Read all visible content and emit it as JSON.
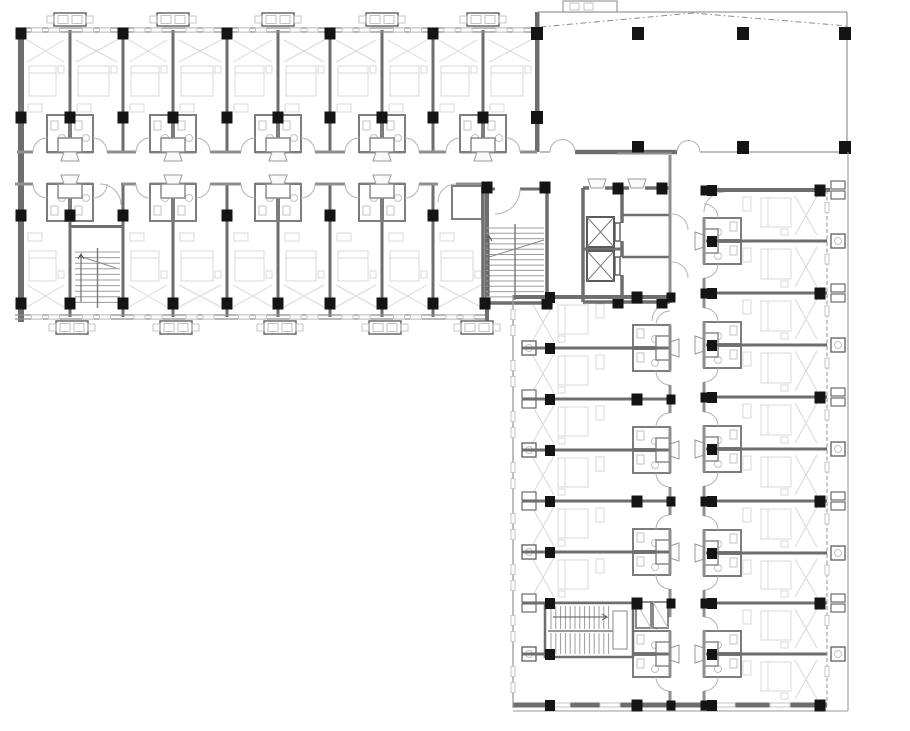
{
  "document": {
    "type": "architectural-floor-plan",
    "canvas": {
      "width": 910,
      "height": 731,
      "background": "#ffffff"
    },
    "summary": {
      "guest_rooms_top_wing": 18,
      "guest_rooms_bottom_wing": 17,
      "elevators": 2,
      "stairways": 3,
      "hall_columns": 6,
      "corridors": 2
    }
  },
  "colors": {
    "wall": "#6e6e6e",
    "wall_light": "#8f8f8f",
    "thin": "#9a9a9a",
    "column": "#141414",
    "fixture": "#c2c2c2",
    "furniture": "#d8d8d8",
    "door": "#b3b3b3",
    "tick": "#c6c6c6",
    "dash": "#8d8d8d",
    "white": "#ffffff"
  },
  "top_wing": {
    "party_walls": [
      21,
      70,
      123,
      173,
      227,
      278,
      330,
      382,
      433,
      483
    ],
    "left_wall_x": 21,
    "window_top_y": 30,
    "window_bottom_y": 317,
    "corridor_y": [
      152,
      184
    ],
    "top_row_span": [
      32,
      152
    ],
    "bottom_row_span": [
      184,
      315
    ],
    "end_wall_top": 537,
    "end_wall_bottom": 487,
    "pairs_top": [
      70,
      173,
      278,
      382,
      483
    ],
    "pairs_bottom": [
      70,
      173,
      278,
      382
    ],
    "single_door_bottom": [
      438,
      456
    ],
    "condensers_top": [
      70,
      173,
      278,
      382,
      483
    ],
    "condensers_bottom": [
      72,
      176,
      280,
      385,
      477
    ],
    "columns_y33": [
      21,
      123,
      227,
      330,
      433
    ],
    "columns_y117": [
      21,
      70,
      123,
      173,
      227,
      278,
      330,
      382,
      433,
      483
    ],
    "columns_y215": [
      21,
      70,
      123,
      227,
      330,
      433
    ],
    "columns_y303": [
      21,
      70,
      123,
      173,
      227,
      278,
      330,
      382,
      433
    ],
    "stair_bay": {
      "walls": [
        70,
        123
      ],
      "top_y": 225,
      "treads": [
        75,
        252,
        120,
        308
      ]
    }
  },
  "hall": {
    "left_wall_x": 537,
    "top_y": 12,
    "right_x": 847,
    "bottom_y": 152,
    "heavy_segment": [
      575,
      677
    ],
    "door_openings": [
      [
        550,
        575
      ],
      [
        677,
        700
      ]
    ],
    "canopy": [
      563,
      1,
      54,
      11
    ],
    "ridge_dash": [
      [
        540,
        27
      ],
      [
        693,
        13
      ],
      [
        847,
        26
      ]
    ],
    "columns": [
      [
        638,
        33
      ],
      [
        743,
        33
      ],
      [
        845,
        33
      ],
      [
        638,
        147
      ],
      [
        743,
        147
      ],
      [
        845,
        147
      ],
      [
        537,
        33
      ],
      [
        537,
        117
      ]
    ]
  },
  "core": {
    "vestibule_wall_y": 189,
    "vestibule_gap": [
      495,
      520
    ],
    "stair": {
      "x1": 483,
      "x2": 547,
      "y1": 189,
      "y2": 305,
      "treads_y": [
        228,
        300
      ],
      "rail_x": 515
    },
    "elevator_shaft": {
      "x1": 583,
      "x2": 622,
      "y1": 188,
      "y2": 302
    },
    "elevator_cars": [
      [
        587,
        217,
        27,
        30
      ],
      [
        587,
        251,
        27,
        30
      ]
    ],
    "service_rooms": {
      "x1": 622,
      "x2": 670,
      "dividers_y": [
        215,
        257
      ]
    },
    "door_marks_up": [
      597,
      637
    ],
    "columns": [
      [
        487,
        187
      ],
      [
        545,
        187
      ],
      [
        485,
        303
      ],
      [
        547,
        303
      ],
      [
        618,
        188
      ],
      [
        662,
        188
      ],
      [
        618,
        302
      ],
      [
        662,
        302
      ]
    ]
  },
  "bottom_wing": {
    "corridor_x": [
      670,
      704
    ],
    "left_column": {
      "room_x": [
        522,
        670
      ],
      "walls": [
        297,
        348,
        399,
        450,
        501,
        552,
        603,
        654,
        705
      ],
      "heavy": [
        297,
        399,
        501,
        603,
        705
      ],
      "pairs": [
        348,
        450,
        552,
        654
      ],
      "col_x": [
        550,
        637
      ],
      "window_x": 513,
      "top_door_gap": [
        303,
        321
      ]
    },
    "right_column": {
      "room_x": [
        706,
        827
      ],
      "walls": [
        190,
        241,
        293,
        345,
        397,
        449,
        501,
        553,
        603,
        654,
        705
      ],
      "heavy": [
        190,
        293,
        397,
        501,
        603,
        705
      ],
      "pairs": [
        241,
        345,
        449,
        553,
        654
      ],
      "col_x": [
        712,
        820
      ],
      "glazing_x": 827,
      "ac_x": 831,
      "top_door_gap": [
        192,
        212
      ]
    },
    "bottom_wall_y": 705,
    "eave_x": 848,
    "eave_bottom_y": 711,
    "stair": {
      "x1": 545,
      "x2": 633,
      "y1": 603,
      "y2": 657,
      "rail_y": 631
    },
    "shafts": [
      [
        636,
        602,
        15,
        26
      ],
      [
        653,
        602,
        15,
        26
      ]
    ]
  }
}
